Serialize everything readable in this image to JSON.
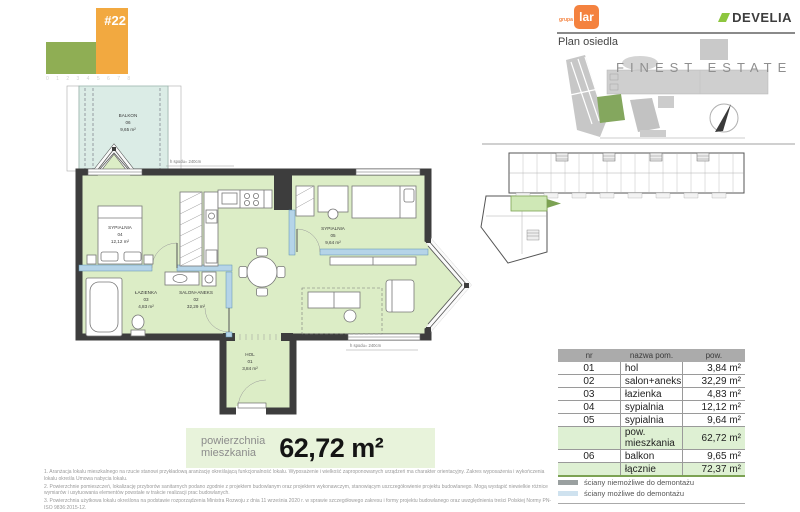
{
  "building_logo": {
    "unit": "#22",
    "scale_marks": "0 1 2 3 4 5 6 7 8"
  },
  "brand": {
    "grupa": "grupa",
    "lar": "lar",
    "develia": "DEVELIA"
  },
  "site_plan": {
    "title": "Plan osiedla",
    "watermark": "FINEST ESTATE"
  },
  "floor_plan": {
    "rooms": [
      {
        "name": "BALKON",
        "num": "06",
        "area": "9,65 m²"
      },
      {
        "name": "SYPIALNIA",
        "num": "04",
        "area": "12,12 m²"
      },
      {
        "name": "ŁAZIENKA",
        "num": "03",
        "area": "4,83 m²"
      },
      {
        "name": "SALON+ANEKS",
        "num": "02",
        "area": "32,29 m²"
      },
      {
        "name": "HOL",
        "num": "01",
        "area": "3,84 m²"
      },
      {
        "name": "SYPIALNIA",
        "num": "05",
        "area": "9,64 m²"
      }
    ],
    "annotations": [
      "h spodu= 240cm",
      "h spodu= 240cm"
    ]
  },
  "area_badge": {
    "label_line1": "powierzchnia",
    "label_line2": "mieszkania",
    "value": "62,72 m²"
  },
  "room_table": {
    "headers": [
      "nr",
      "nazwa pom.",
      "pow."
    ],
    "rows": [
      {
        "nr": "01",
        "name": "hol",
        "area": "3,84 m²"
      },
      {
        "nr": "02",
        "name": "salon+aneks",
        "area": "32,29 m²"
      },
      {
        "nr": "03",
        "name": "łazienka",
        "area": "4,83 m²"
      },
      {
        "nr": "04",
        "name": "sypialnia",
        "area": "12,12 m²"
      },
      {
        "nr": "05",
        "name": "sypialnia",
        "area": "9,64 m²"
      },
      {
        "nr": "",
        "name": "pow. mieszkania",
        "area": "62,72 m²"
      },
      {
        "nr": "06",
        "name": "balkon",
        "area": "9,65 m²"
      },
      {
        "nr": "",
        "name": "łącznie",
        "area": "72,37 m²"
      }
    ]
  },
  "legend": {
    "items": [
      {
        "label": "ściany niemożliwe do demontażu"
      },
      {
        "label": "ściany możliwe do demontażu"
      }
    ]
  },
  "footnotes": [
    "1. Aranżacja lokalu mieszkalnego na rzucie stanowi przykładową aranżację określającą funkcjonalność lokalu. Wyposażenie i wielkość zaproponowanych urządzeń ma charakter orientacyjny. Zakres wyposażenia i wykończenia lokalu określa Umowa nabycia lokalu.",
    "2. Powierzchnie pomieszczeń, lokalizację przyborów sanitarnych podano zgodnie z projektem budowlanym oraz projektem wykonawczym, stanowiącym uszczegółowienie projektu budowlanego. Mogą wystąpić niewielkie różnice wymiarów i usytuowania elementów powstałe w trakcie realizacji prac budowlanych.",
    "3. Powierzchnia użytkowa lokalu określona na podstawie rozporządzenia Ministra Rozwoju z dnia 11 września 2020 r. w sprawie szczegółowego zakresu i formy projektu budowlanego oraz uwzględnienia treści Polskiej Normy PN-ISO 9836:2015-12.",
    "4. Do powierzchni użytkowej lokalu nie wlicza się powierzchni elementów nadających się do demontażu np. ścianek działowych. Podane wymiary są wymiarami w świetle pionowych przegród (ścian) w stanie surowym, nie uwzględniają wykończenia tynkiem."
  ],
  "colors": {
    "wall": "#3d3d3d",
    "demountable_wall": "#b5d4e8",
    "interior": "#dcedc6",
    "balcony": "#dbece6",
    "accent_green": "#7ca253",
    "lar_orange": "#f4823f",
    "logo_orange": "#f2a940",
    "logo_green": "#8fae54",
    "develia_green": "#8dc63f"
  }
}
